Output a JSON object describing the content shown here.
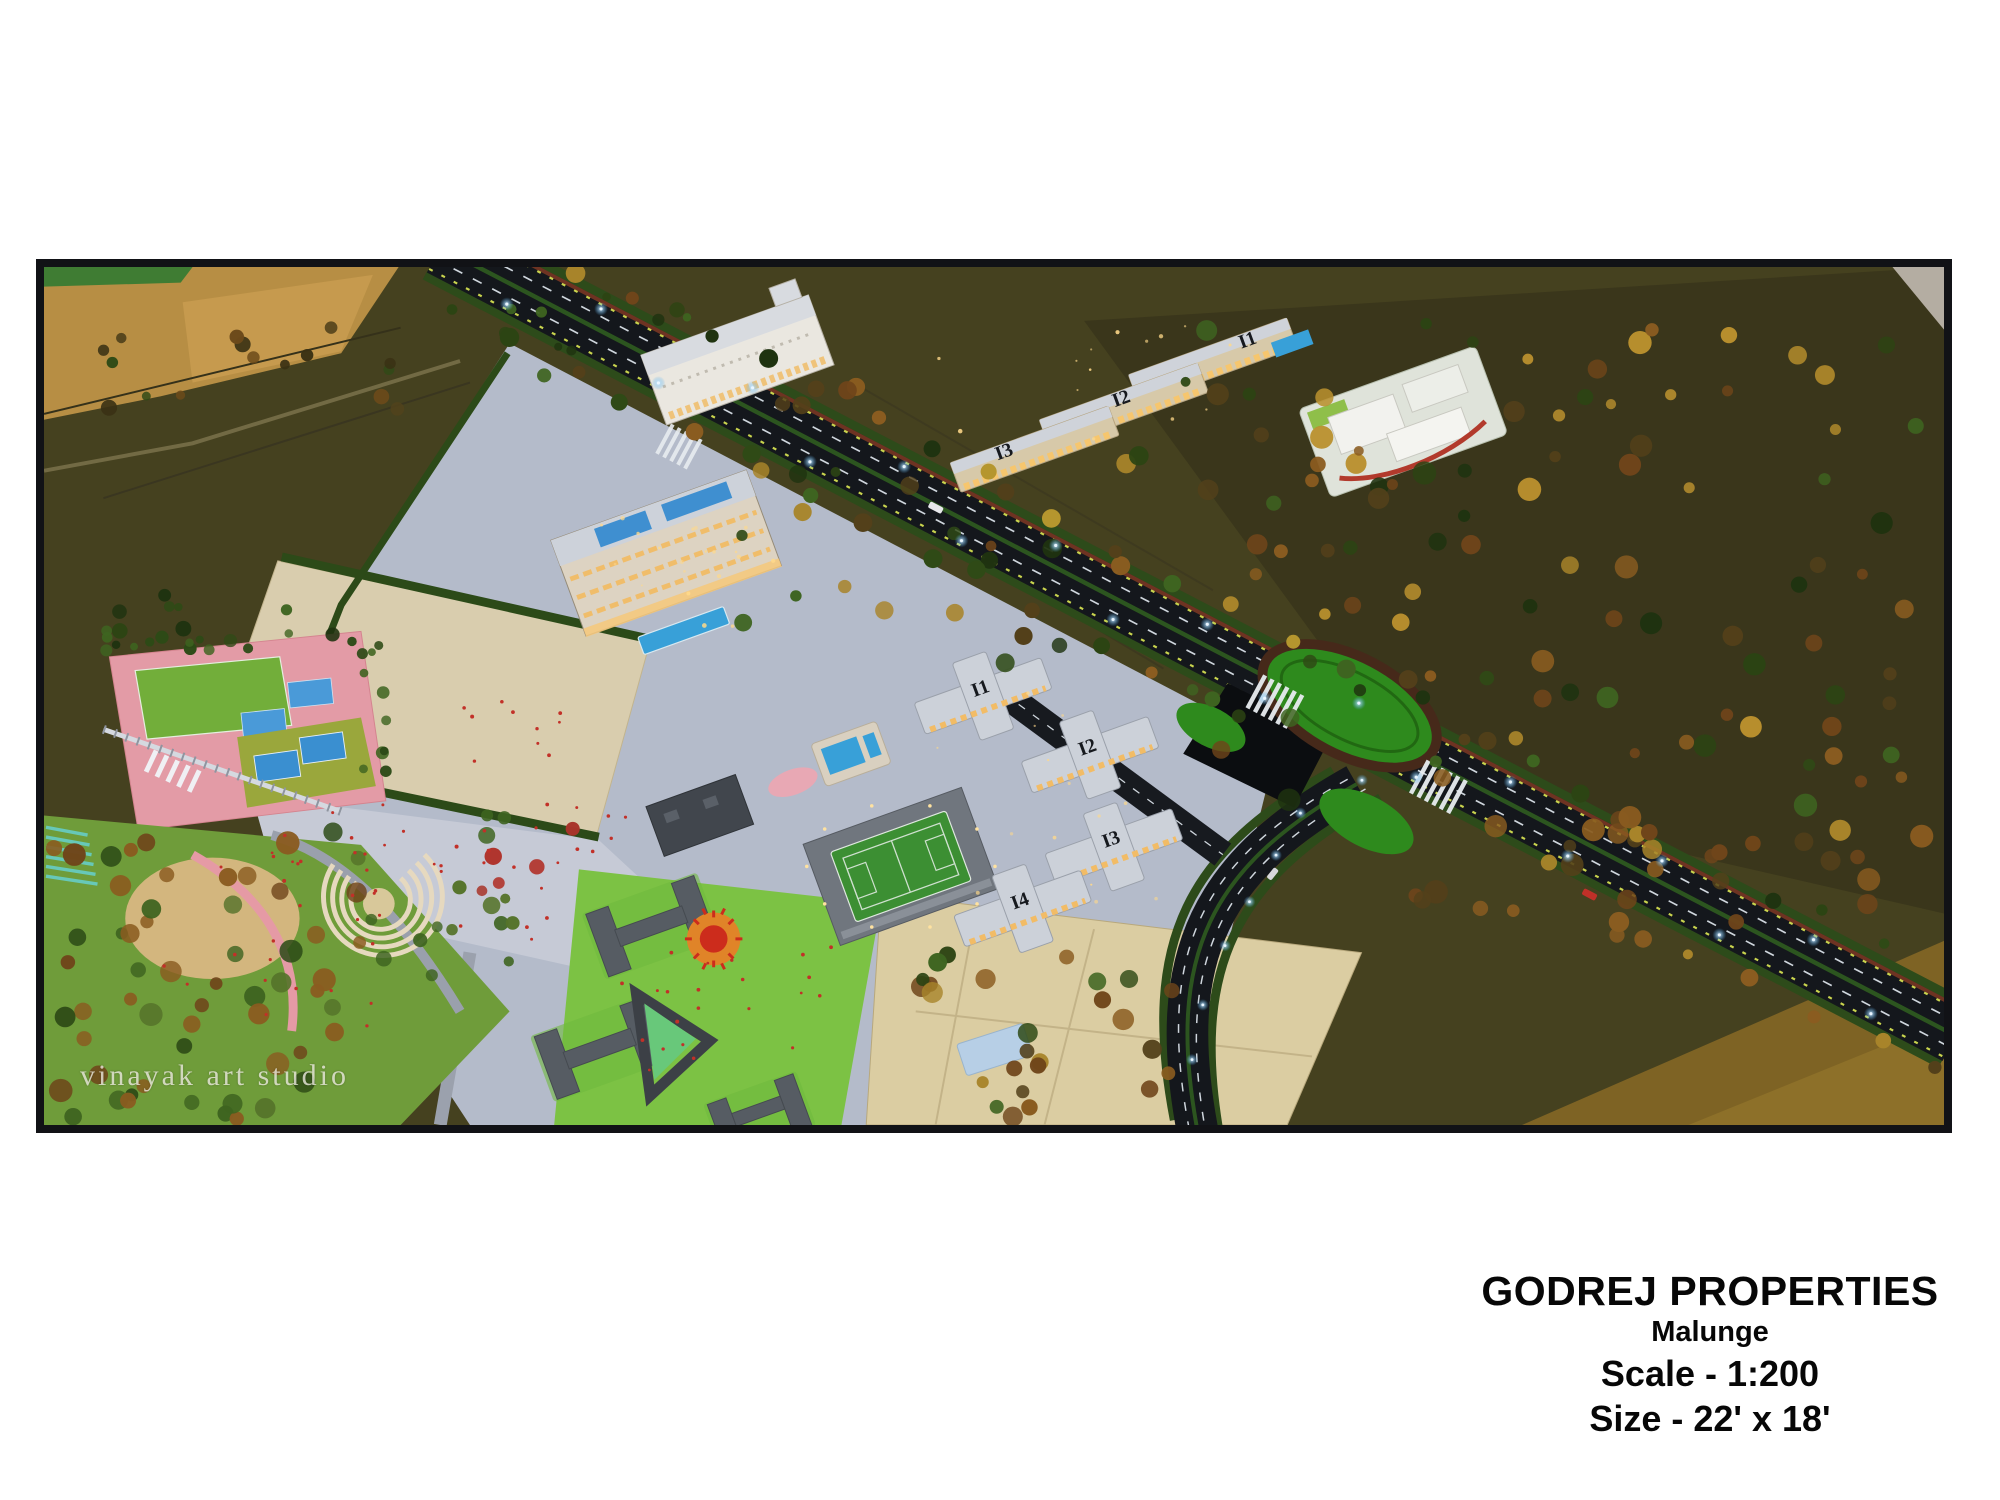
{
  "page": {
    "background": "#ffffff"
  },
  "caption": {
    "developer": "GODREJ PROPERTIES",
    "project": "Malunge",
    "scale": "Scale - 1:200",
    "size": "Size - 22' x 18'"
  },
  "photo": {
    "watermark": "vinayak art studio",
    "tower_labels": {
      "north": [
        "I1",
        "I2",
        "I3"
      ],
      "central": [
        "I1",
        "I2",
        "I3",
        "I4"
      ]
    },
    "colors": {
      "frame_border": "#111216",
      "ground_olive": "#45411f",
      "hill_olive_dark": "#3a361b",
      "farm_tan": "#b78e44",
      "mustard_field": "#7e6324",
      "road_asphalt": "#14171c",
      "lane_marking": "#cfd6dd",
      "median_green": "#2c551f",
      "interchange_island_green": "#2e8a1d",
      "township_plaza": "#b4bbca",
      "open_plot_sand": "#d9cdae",
      "pool_blue": "#38a0d8",
      "residential_roof": "#ccd1d9",
      "lit_window_warm": "#f2bc66",
      "sports_field_green": "#72ae3a",
      "court_blue": "#4a9ad8",
      "walkway_pink": "#e39ba6",
      "school_block_gray": "#565c63",
      "lawn_bright_green": "#7cc244",
      "sun_mosaic_orange": "#e08428",
      "sun_mosaic_red": "#cc2c1c",
      "people_red": "#c23028",
      "streetlight_glow": "#9fd8ff"
    }
  }
}
